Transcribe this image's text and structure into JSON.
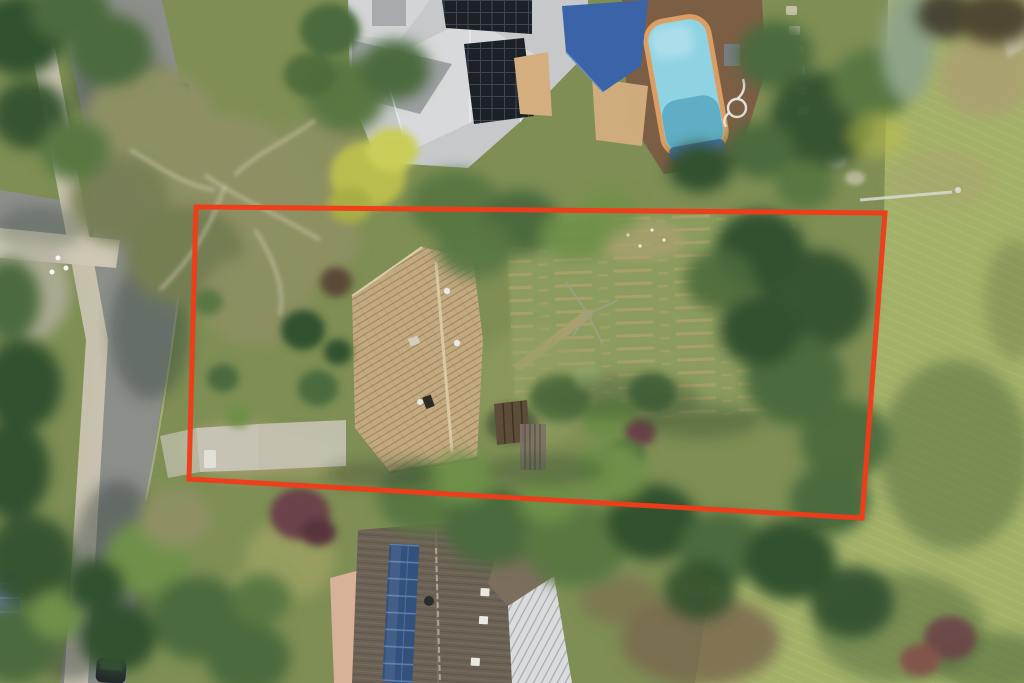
{
  "scene": {
    "type": "aerial-drone-photo",
    "description": "Top-down aerial photograph of a suburban block outlined in red: street and footpath at left under a large khaki gum-tree canopy, grey-roofed neighbour house with solar panels, blue shade sail and swimming pool at top, tan tile-roof house with driveway and rear paddock inside the red outline, dark-roofed neighbour house with blue solar panels below, open grass meadow at right.",
    "width": 1024,
    "height": 683
  },
  "boundary": {
    "label": "property-boundary-outline",
    "points": "196,207 885,213 862,518 189,479",
    "stroke_width": 5,
    "color": "#f13c1a"
  },
  "palette": {
    "boundary_red": "#f13c1a",
    "grass_base": "#7e8e54",
    "meadow": "#a3b068",
    "meadow_shadow": "#4d673c",
    "paddock": "#8c9c5f",
    "paddock_row": "#b4a46b",
    "road": "#8c8e8a",
    "road_shadow": "#33413a",
    "path_concrete": "#cdc7b4",
    "driveway": "#c6c3b5",
    "dirt_tan": "#ab9f72",
    "dirt_brown": "#7a6a50",
    "lawn_tan": "#9aa061",
    "tree_dark": "#33512e",
    "tree_mid": "#4c6a3c",
    "tree_light": "#6f9048",
    "tree_olive": "#5a7743",
    "tree_khaki": "#8e9063",
    "tree_khaki_dark": "#757d52",
    "tree_yellow": "#b9bd4d",
    "tree_sage": "#8fa387",
    "tree_plum": "#6b4348",
    "branch_pale": "#cfc9ae",
    "roof_top_light": "#d8d9db",
    "roof_top_mid": "#c6c8ca",
    "roof_top_dark": "#9da0a2",
    "solar_dark": "#1c2127",
    "roof_main_tan": "#c2a97f",
    "roof_ridge": "#dccba6",
    "shed_brown": "#5d4c38",
    "fence_grey": "#7d7266",
    "roof_bottom_dark": "#6b6154",
    "roof_bottom_light": "#7b6e5c",
    "roof_white": "#d9dbdc",
    "solar_blue": "#33517d",
    "solar_blue_grid": "#5f7fae",
    "wall_pink": "#d7b298",
    "pool_water": "#8fd3e3",
    "pool_water_deep": "#57a7c0",
    "pool_coping": "#db9d62",
    "pool_cover_blue": "#3c66a0",
    "deck_brown": "#7c5e44",
    "sail_blue": "#3a63a8",
    "car_dark": "#2b3036",
    "white_detail": "#e9e9e2",
    "courtyard_tan": "#d4ae7e"
  }
}
